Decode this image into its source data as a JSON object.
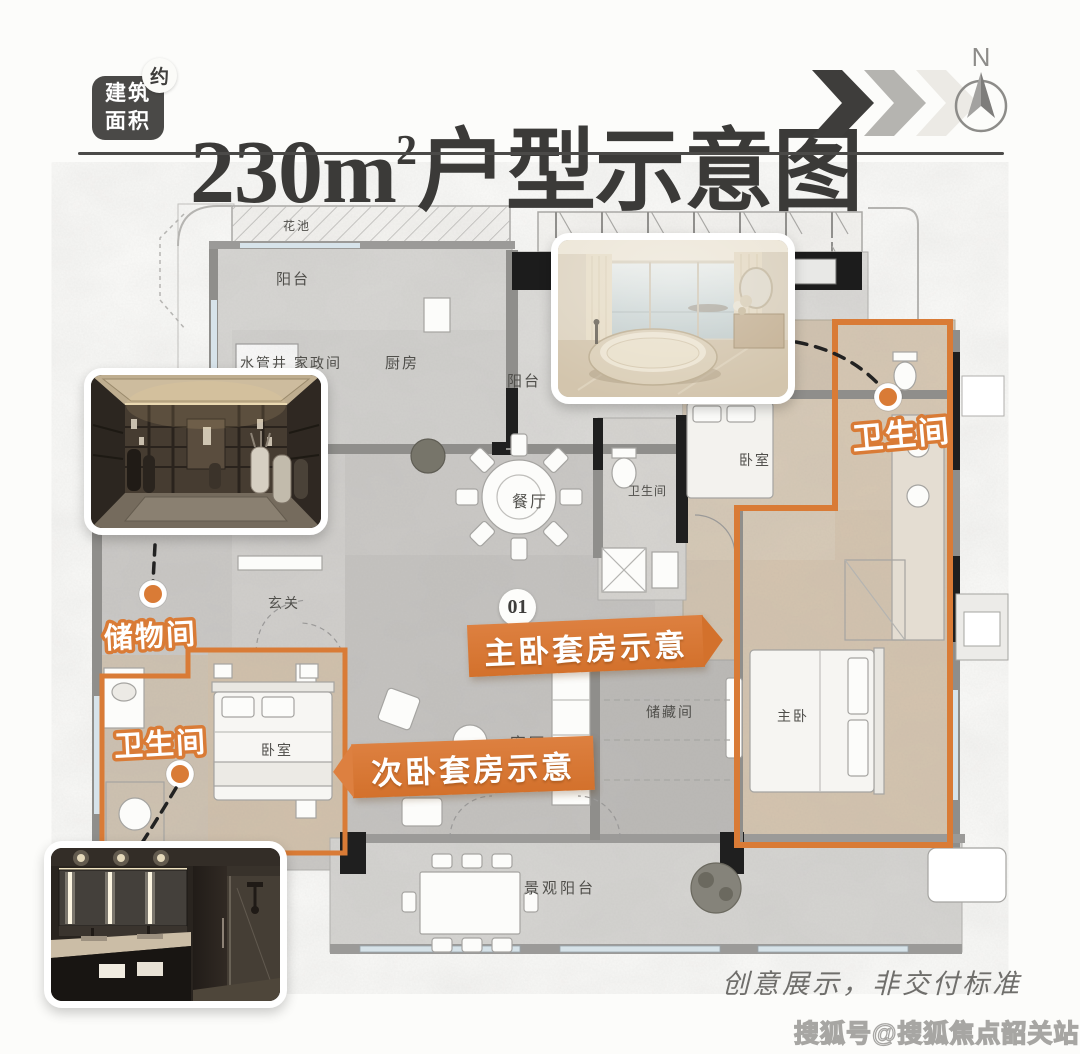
{
  "header": {
    "badge": {
      "line1": "建筑",
      "line2": "面积",
      "approx": "约"
    },
    "title": {
      "main": "230m",
      "sup": "2",
      "tail": "户型示意图"
    },
    "compass_label": "N"
  },
  "icons": {
    "direction_chevrons": "triple-chevron-right",
    "compass": "north-arrow"
  },
  "plan": {
    "unit_badge": "01",
    "room_labels": [
      {
        "name": "flower-bed",
        "text": "花池"
      },
      {
        "name": "balcony-top",
        "text": "阳台"
      },
      {
        "name": "water-pipe-shaft",
        "text": "水管井"
      },
      {
        "name": "housekeeping-room",
        "text": "家政间"
      },
      {
        "name": "kitchen",
        "text": "厨房"
      },
      {
        "name": "balcony-mid",
        "text": "阳台"
      },
      {
        "name": "dining-room",
        "text": "餐厅"
      },
      {
        "name": "bathroom-small",
        "text": "卫生间"
      },
      {
        "name": "bedroom-mid",
        "text": "卧室"
      },
      {
        "name": "foyer",
        "text": "玄关"
      },
      {
        "name": "living-room",
        "text": "客厅"
      },
      {
        "name": "storeroom",
        "text": "储藏间"
      },
      {
        "name": "master-bedroom",
        "text": "主卧"
      },
      {
        "name": "bedroom-left",
        "text": "卧室"
      },
      {
        "name": "view-balcony",
        "text": "景观阳台"
      }
    ],
    "callouts": {
      "master_bath": "卫生间",
      "storage": "储物间",
      "second_bath": "卫生间"
    },
    "ribbons": {
      "master": "主卧套房示意",
      "secondary": "次卧套房示意"
    }
  },
  "footer": {
    "disclaimer": "创意展示，非交付标准",
    "watermark": "搜狐号@搜狐焦点韶关站"
  },
  "colors": {
    "accent": "#D97B36",
    "ink": "#3B3A38",
    "floor_gray": "#cbc9c6",
    "floor_warm": "#d2c3af"
  }
}
